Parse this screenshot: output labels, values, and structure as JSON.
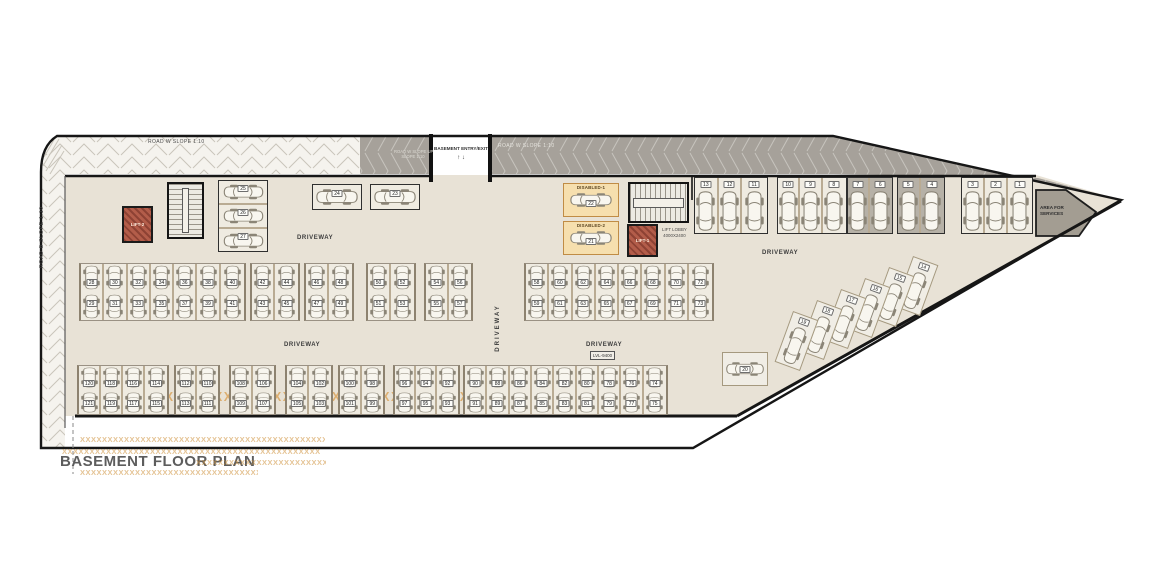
{
  "texts": {
    "title": "BASEMENT FLOOR PLAN",
    "road_top_left": "ROAD W SLOPE 1:10",
    "road_top_right": "ROAD W SLOPE 1:10",
    "ramp_line1": "ROAD W SLOPE UP",
    "ramp_line2": "SLOPE 1:10",
    "entry": "BASEMENT ENTRY/EXIT",
    "entry_arrows": "↑ ↓",
    "road_left": "ROAD B SLOPE 1:10",
    "driveway": "DRIVEWAY",
    "lvl": "LVL-9400",
    "lift1": "LIFT-1",
    "lift2": "LIFT-2",
    "lift_lobby_l1": "LIFT LOBBY",
    "lift_lobby_l2": "4000X2400",
    "services_l1": "AREA FOR",
    "services_l2": "SERVICES",
    "watermark": "XXXXXXXXXXXXXXXXXXXXXXXXXXXXXXXXXXXXXXXXXXXXXXXXXXXXXXXXXXXX"
  },
  "colors": {
    "plate": "#e8e2d6",
    "road_dark": "#a6a19a",
    "road_light": "#f5f3ee",
    "bay_light": "#efebe1",
    "bay_dark": "#b6b1a7",
    "divider_tan": "#b9ab93",
    "lift_red": "#b35d4a",
    "disabled_bg": "#f6dfae",
    "watermark_orange": "#cd8f38",
    "wall": "#161616"
  },
  "parking": {
    "top_row": {
      "y": 177,
      "h": 57,
      "num_top": 3,
      "car_top": 12,
      "groups": [
        {
          "x": 694,
          "w": 74,
          "dark": false,
          "nums": [
            "13",
            "12",
            "11"
          ]
        },
        {
          "x": 777,
          "w": 70,
          "dark": false,
          "nums": [
            "10",
            "9",
            "8"
          ]
        },
        {
          "x": 847,
          "w": 46,
          "dark": true,
          "nums": [
            "7",
            "6"
          ]
        },
        {
          "x": 897,
          "w": 48,
          "dark": true,
          "nums": [
            "5",
            "4"
          ]
        },
        {
          "x": 961,
          "w": 72,
          "dark": false,
          "nums": [
            "3",
            "2",
            "1"
          ]
        }
      ]
    },
    "mid_band": {
      "y": 263,
      "h": 58,
      "num_top": 15,
      "num_bot": 36,
      "groups": [
        {
          "x": 79,
          "w": 167,
          "pairs": [
            [
              "28",
              "29"
            ],
            [
              "30",
              "31"
            ],
            [
              "32",
              "33"
            ],
            [
              "34",
              "35"
            ],
            [
              "36",
              "37"
            ],
            [
              "38",
              "39"
            ],
            [
              "40",
              "41"
            ]
          ]
        },
        {
          "x": 250,
          "w": 50,
          "pairs": [
            [
              "42",
              "43"
            ],
            [
              "44",
              "45"
            ]
          ]
        },
        {
          "x": 304,
          "w": 50,
          "pairs": [
            [
              "46",
              "47"
            ],
            [
              "48",
              "49"
            ]
          ]
        },
        {
          "x": 366,
          "w": 50,
          "pairs": [
            [
              "50",
              "51"
            ],
            [
              "52",
              "53"
            ]
          ]
        },
        {
          "x": 424,
          "w": 49,
          "pairs": [
            [
              "54",
              "55"
            ],
            [
              "56",
              "57"
            ]
          ]
        },
        {
          "x": 524,
          "w": 190,
          "pairs": [
            [
              "58",
              "59"
            ],
            [
              "60",
              "61"
            ],
            [
              "62",
              "63"
            ],
            [
              "64",
              "65"
            ],
            [
              "66",
              "67"
            ],
            [
              "68",
              "69"
            ],
            [
              "70",
              "71"
            ],
            [
              "72",
              "73"
            ]
          ]
        }
      ]
    },
    "bottom_band": {
      "y": 365,
      "h": 50,
      "num_top": 14,
      "num_bot": 34,
      "groups": [
        {
          "x": 77,
          "w": 92,
          "pairs": [
            [
              "120",
              "121"
            ],
            [
              "118",
              "119"
            ],
            [
              "116",
              "117"
            ],
            [
              "114",
              "115"
            ]
          ]
        },
        {
          "x": 174,
          "w": 46,
          "pairs": [
            [
              "112",
              "113"
            ],
            [
              "110",
              "111"
            ]
          ]
        },
        {
          "x": 229,
          "w": 47,
          "pairs": [
            [
              "108",
              "109"
            ],
            [
              "106",
              "107"
            ]
          ]
        },
        {
          "x": 285,
          "w": 48,
          "pairs": [
            [
              "104",
              "105"
            ],
            [
              "102",
              "103"
            ]
          ]
        },
        {
          "x": 338,
          "w": 47,
          "pairs": [
            [
              "100",
              "101"
            ],
            [
              "98",
              "99"
            ]
          ]
        },
        {
          "x": 393,
          "w": 67,
          "pairs": [
            [
              "96",
              "97"
            ],
            [
              "94",
              "95"
            ],
            [
              "92",
              "93"
            ]
          ]
        },
        {
          "x": 463,
          "w": 205,
          "pairs": [
            [
              "90",
              "91"
            ],
            [
              "88",
              "89"
            ],
            [
              "86",
              "87"
            ],
            [
              "84",
              "85"
            ],
            [
              "82",
              "83"
            ],
            [
              "80",
              "81"
            ],
            [
              "78",
              "79"
            ],
            [
              "76",
              "77"
            ],
            [
              "74",
              "75"
            ]
          ]
        }
      ]
    },
    "stack_left": {
      "x": 218,
      "y": 180,
      "w": 50,
      "row_h": 24,
      "nums": [
        "25",
        "26",
        "27"
      ]
    },
    "parallel_top": [
      {
        "x": 312,
        "y": 184,
        "w": 50,
        "h": 26,
        "num": "24"
      },
      {
        "x": 370,
        "y": 184,
        "w": 50,
        "h": 26,
        "num": "23"
      }
    ],
    "disabled": {
      "x": 563,
      "y": 183,
      "w": 56,
      "box_h": 34,
      "gap": 4,
      "items": [
        {
          "label": "DISABLED-1",
          "num": "22"
        },
        {
          "label": "DISABLED-2",
          "num": "21"
        }
      ]
    },
    "diagonal": {
      "cx": 916,
      "cy": 286,
      "dx": -24,
      "dy": 11,
      "w": 27,
      "h": 54,
      "angle": 20,
      "nums": [
        "14",
        "15",
        "16",
        "17",
        "18",
        "19"
      ]
    },
    "single_20": {
      "x": 722,
      "y": 352,
      "w": 46,
      "h": 34,
      "num": "20"
    }
  },
  "driveway_labels": [
    {
      "x": 297,
      "y": 235,
      "rot": 0,
      "lvl": false
    },
    {
      "x": 762,
      "y": 250,
      "rot": 0,
      "lvl": false
    },
    {
      "x": 498,
      "y": 328,
      "rot": -90,
      "lvl": false
    },
    {
      "x": 284,
      "y": 342,
      "rot": 0,
      "lvl": false
    },
    {
      "x": 586,
      "y": 342,
      "rot": 0,
      "lvl": true
    }
  ],
  "watermark_rows": [
    {
      "x": 80,
      "y": 435,
      "w": 245,
      "fs": 7.5
    },
    {
      "x": 62,
      "y": 447,
      "w": 258,
      "fs": 7.5
    },
    {
      "x": 196,
      "y": 458,
      "w": 130,
      "fs": 7.5
    },
    {
      "x": 80,
      "y": 468,
      "w": 178,
      "fs": 7.5
    }
  ],
  "watermark_large": {
    "x": 86,
    "y": 390,
    "w": 505,
    "fs": 12.5
  }
}
